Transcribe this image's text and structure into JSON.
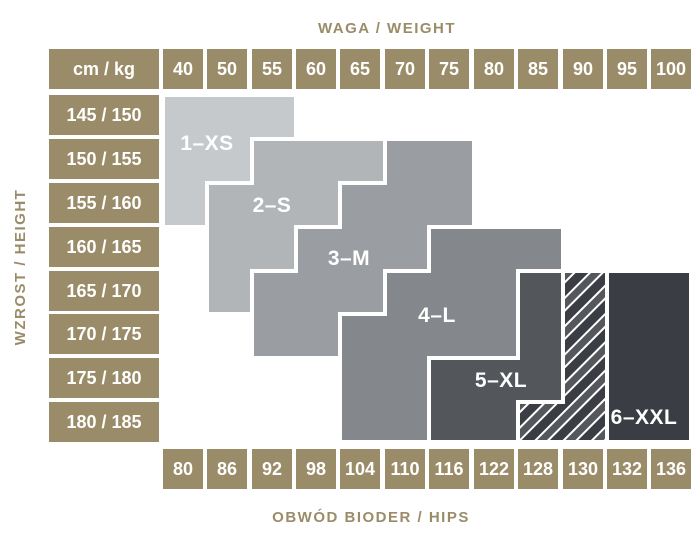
{
  "titles": {
    "top": "WAGA / WEIGHT",
    "left": "WZROST / HEIGHT",
    "bottom": "OBWÓD BIODER / HIPS",
    "corner": "cm / kg"
  },
  "weights": [
    "40",
    "50",
    "55",
    "60",
    "65",
    "70",
    "75",
    "80",
    "85",
    "90",
    "95",
    "100"
  ],
  "heights": [
    "145 / 150",
    "150 / 155",
    "155 / 160",
    "160 / 165",
    "165 / 170",
    "170 / 175",
    "175 / 180",
    "180 / 185"
  ],
  "hips": [
    "80",
    "86",
    "92",
    "98",
    "104",
    "110",
    "116",
    "122",
    "128",
    "130",
    "132",
    "136"
  ],
  "palette": {
    "khaki": "#9b8c69",
    "cell_text": "#ffffff",
    "separator": "#ffffff"
  },
  "sizes": [
    {
      "label": "1–XS",
      "color": "#c6c9cb",
      "points": "163,95 296,95 296,227 163,227"
    },
    {
      "label": "2–S",
      "color": "#b2b5b8",
      "points": "252,139 385,139 385,314 207,314 207,183 252,183"
    },
    {
      "label": "3–M",
      "color": "#9a9da1",
      "points": "385,139 474,139 474,358 252,358 252,271 296,271 296,227 340,227 340,183 385,183"
    },
    {
      "label": "4–L",
      "color": "#84878b",
      "points": "429,227 563,227 563,271 518,271 518,442 340,442 340,314 385,314 385,271 429,271"
    },
    {
      "label": "5–XL",
      "color": "#53565b",
      "points": "518,271 563,271 563,442 429,442 429,358 518,358"
    },
    {
      "label": "6–XXL",
      "color": "#3a3d44",
      "points": "607,271 691,271 691,442 607,442"
    }
  ],
  "overlap": {
    "meaning": "5–XL / 6–XXL overlap (hatched)",
    "points": "563,271 607,271 607,442 518,442 518,402 563,402",
    "stripe_dark": "#3a3d44",
    "stripe_mid": "#54575c",
    "stripe_line": "#ffffff"
  },
  "chart_data": {
    "type": "heatmap",
    "title": "Size chart: weight vs height with hip circumference",
    "x_axis": {
      "title": "WAGA / WEIGHT",
      "unit_label": "cm / kg",
      "categories": [
        40,
        50,
        55,
        60,
        65,
        70,
        75,
        80,
        85,
        90,
        95,
        100
      ]
    },
    "y_axis": {
      "title": "WZROST / HEIGHT",
      "categories": [
        "145 / 150",
        "150 / 155",
        "155 / 160",
        "160 / 165",
        "165 / 170",
        "170 / 175",
        "175 / 180",
        "180 / 185"
      ]
    },
    "x_axis_bottom": {
      "title": "OBWÓD BIODER / HIPS",
      "categories": [
        80,
        86,
        92,
        98,
        104,
        110,
        116,
        122,
        128,
        130,
        132,
        136
      ]
    },
    "legend_position": "labels-inside-regions",
    "grid": false,
    "regions": [
      {
        "size": "1–XS",
        "fill": "#c6c9cb",
        "rows": [
          {
            "height": "145 / 150",
            "weights": "40–55",
            "hips": "80–92"
          },
          {
            "height": "150 / 155",
            "weights": "40–50",
            "hips": "80–86"
          },
          {
            "height": "155 / 160",
            "weights": "40",
            "hips": "80"
          }
        ]
      },
      {
        "size": "2–S",
        "fill": "#b2b5b8",
        "rows": [
          {
            "height": "150 / 155",
            "weights": "55–65",
            "hips": "92–104"
          },
          {
            "height": "155 / 160",
            "weights": "50–60",
            "hips": "86–98"
          },
          {
            "height": "160 / 165",
            "weights": "50–55",
            "hips": "86–92"
          },
          {
            "height": "165 / 170",
            "weights": "50",
            "hips": "86"
          }
        ]
      },
      {
        "size": "3–M",
        "fill": "#9a9da1",
        "rows": [
          {
            "height": "150 / 155",
            "weights": "70–75",
            "hips": "110–116"
          },
          {
            "height": "155 / 160",
            "weights": "65–75",
            "hips": "104–116"
          },
          {
            "height": "160 / 165",
            "weights": "60–70",
            "hips": "98–110"
          },
          {
            "height": "165 / 170",
            "weights": "55–65",
            "hips": "92–104"
          },
          {
            "height": "170 / 175",
            "weights": "55–60",
            "hips": "92–98"
          }
        ]
      },
      {
        "size": "4–L",
        "fill": "#84878b",
        "rows": [
          {
            "height": "160 / 165",
            "weights": "75–85",
            "hips": "116–128"
          },
          {
            "height": "165 / 170",
            "weights": "70–80",
            "hips": "110–122"
          },
          {
            "height": "170 / 175",
            "weights": "65–80",
            "hips": "104–122"
          },
          {
            "height": "175 / 180",
            "weights": "65–70",
            "hips": "104–110"
          },
          {
            "height": "180 / 185",
            "weights": "65–70",
            "hips": "104–110"
          }
        ]
      },
      {
        "size": "5–XL",
        "fill": "#53565b",
        "rows": [
          {
            "height": "165 / 170",
            "weights": "85",
            "hips": "128"
          },
          {
            "height": "170 / 175",
            "weights": "85",
            "hips": "128"
          },
          {
            "height": "175 / 180",
            "weights": "75–85",
            "hips": "116–128"
          },
          {
            "height": "180 / 185",
            "weights": "75–80",
            "hips": "116–122"
          }
        ]
      },
      {
        "size": "5–XL / 6–XXL overlap",
        "fill": "hatched",
        "rows": [
          {
            "height": "165 / 170",
            "weights": "90",
            "hips": "130"
          },
          {
            "height": "170 / 175",
            "weights": "90",
            "hips": "130"
          },
          {
            "height": "175 / 180",
            "weights": "90",
            "hips": "130"
          },
          {
            "height": "180 / 185",
            "weights": "85–90",
            "hips": "128–130"
          }
        ]
      },
      {
        "size": "6–XXL",
        "fill": "#3a3d44",
        "rows": [
          {
            "height": "165 / 170",
            "weights": "95–100",
            "hips": "132–136"
          },
          {
            "height": "170 / 175",
            "weights": "95–100",
            "hips": "132–136"
          },
          {
            "height": "175 / 180",
            "weights": "95–100",
            "hips": "132–136"
          },
          {
            "height": "180 / 185",
            "weights": "95–100",
            "hips": "132–136"
          }
        ]
      }
    ]
  }
}
